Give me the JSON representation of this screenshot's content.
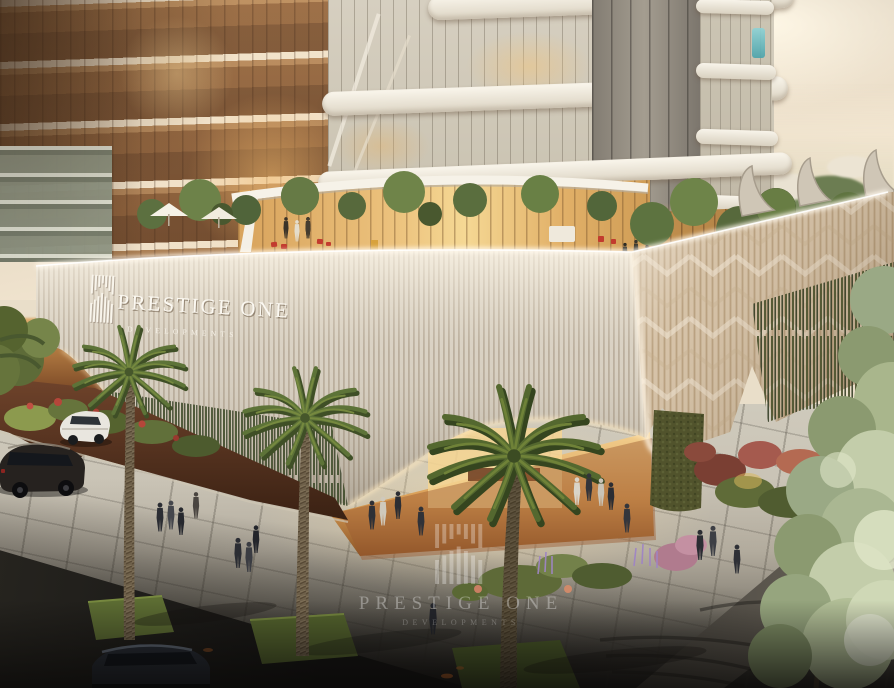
{
  "scene": {
    "kind": "architectural-rendering",
    "subject": "Prestige One Developments sales pavilion with residential tower, rooftop terrace, palm-lined plaza, parked cars and pedestrians at dusk"
  },
  "sign": {
    "title": "PRESTIGE ONE",
    "subtitle": "DEVELOPMENTS"
  },
  "watermark": {
    "title": "PRESTIGE ONE",
    "subtitle": "DEVELOPMENTS"
  },
  "palette": {
    "sky_warm": "#f5e9d3",
    "facade_rib_light": "#d8d0c2",
    "facade_rib_shadow": "#b3a694",
    "facade_right_tan": "#d3bfa4",
    "entry_glow": "#f6d592",
    "bronze_glass": "#8a5f3c",
    "terrace_glass": "#ecc27d",
    "hedge_green": "#3c4a28",
    "palm_green": "#5d7338",
    "plaza_paver": "#cfcabc",
    "road_dark": "#1b1a18",
    "accent_red_chair": "#c23b2e",
    "accent_cyan_glass": "#49a3ab"
  }
}
